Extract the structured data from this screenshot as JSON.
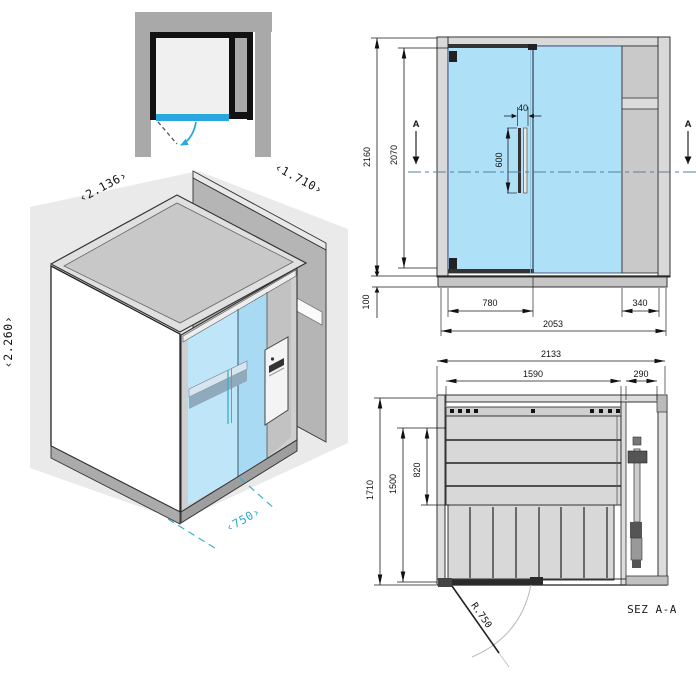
{
  "iso_view": {
    "labels": {
      "width": "‹2.136›",
      "depth": "‹1.710›",
      "height": "‹2.260›",
      "door_width": "‹750›"
    }
  },
  "front_elevation": {
    "section_marker": "A",
    "dims": {
      "total_height": "2160",
      "door_height": "2070",
      "base_height": "100",
      "handle_offset": "40",
      "handle_length": "600",
      "door_width": "780",
      "panel_width": "340",
      "system_width": "2053"
    }
  },
  "section_view": {
    "title": "SEZ A-A",
    "dims": {
      "total_width": "2133",
      "interior_width": "1590",
      "column_width": "290",
      "total_depth": "1710",
      "interior_depth": "1500",
      "bench_depth": "820",
      "door_radius": "R.750"
    }
  },
  "colors": {
    "glass_blue": "#aee0f8",
    "accent_blue": "#29a8e0",
    "teal": "#31aac8",
    "frame_gray": "#a9a9a9"
  }
}
